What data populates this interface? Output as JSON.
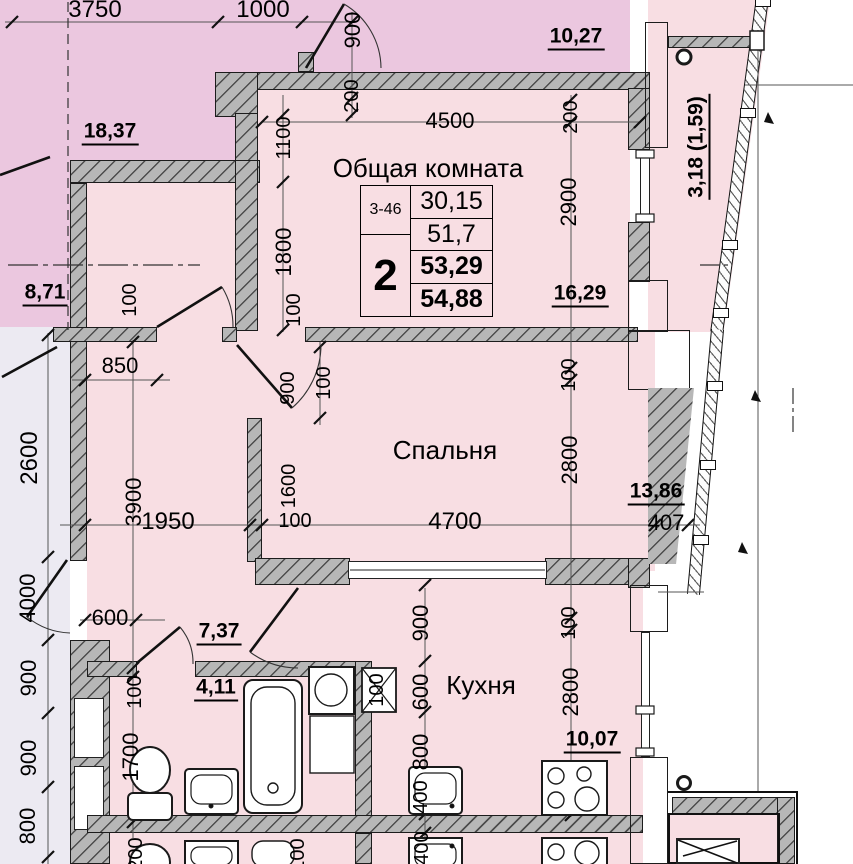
{
  "unit_table": {
    "unit_no": "3-46",
    "rooms_count": "2",
    "living_area": "30,15",
    "total_area": "51,7",
    "area_with_balcony_low": "53,29",
    "area_with_balcony_high": "54,88"
  },
  "rooms": [
    {
      "label": "Общая комната"
    },
    {
      "label": "Спальня"
    },
    {
      "label": "Кухня"
    }
  ],
  "area_values": [
    "18,37",
    "10,27",
    "8,71",
    "16,29",
    "13,86",
    "7,37",
    "4,11",
    "10,07",
    "3,18 (1,59)"
  ],
  "colors": {
    "apartment_fill": "#f8dee3",
    "neighbor_fill": "#ebc7df",
    "corridor_fill": "#eceaf2",
    "wall_gray": "#b7b7b7",
    "line_black": "#1a1a1a"
  },
  "labels": [
    {
      "t": "3750",
      "x": 95,
      "y": 10,
      "r": 0,
      "s": 24,
      "k": "dim"
    },
    {
      "t": "1000",
      "x": 263,
      "y": 10,
      "r": 0,
      "s": 24,
      "k": "dim"
    },
    {
      "t": "900",
      "x": 353,
      "y": 30,
      "r": -90,
      "s": 22,
      "k": "dim"
    },
    {
      "t": "200",
      "x": 352,
      "y": 96,
      "r": -90,
      "s": 20,
      "k": "dim"
    },
    {
      "t": "1100",
      "x": 284,
      "y": 138,
      "r": -90,
      "s": 20,
      "k": "dim"
    },
    {
      "t": "4500",
      "x": 450,
      "y": 121,
      "r": 0,
      "s": 22,
      "k": "dim"
    },
    {
      "t": "200",
      "x": 571,
      "y": 117,
      "r": -90,
      "s": 20,
      "k": "dim"
    },
    {
      "t": "2900",
      "x": 569,
      "y": 202,
      "r": -90,
      "s": 22,
      "k": "dim"
    },
    {
      "t": "1800",
      "x": 284,
      "y": 252,
      "r": -90,
      "s": 22,
      "k": "dim"
    },
    {
      "t": "100",
      "x": 130,
      "y": 300,
      "r": -90,
      "s": 20,
      "k": "dim"
    },
    {
      "t": "100",
      "x": 294,
      "y": 310,
      "r": -90,
      "s": 20,
      "k": "dim"
    },
    {
      "t": "900",
      "x": 288,
      "y": 388,
      "r": -90,
      "s": 20,
      "k": "dim"
    },
    {
      "t": "100",
      "x": 324,
      "y": 383,
      "r": -90,
      "s": 20,
      "k": "dim"
    },
    {
      "t": "100",
      "x": 569,
      "y": 375,
      "r": -90,
      "s": 20,
      "k": "dim"
    },
    {
      "t": "850",
      "x": 120,
      "y": 366,
      "r": 0,
      "s": 22,
      "k": "dim"
    },
    {
      "t": "2600",
      "x": 30,
      "y": 458,
      "r": -90,
      "s": 24,
      "k": "dim"
    },
    {
      "t": "1600",
      "x": 289,
      "y": 486,
      "r": -90,
      "s": 20,
      "k": "dim"
    },
    {
      "t": "2800",
      "x": 570,
      "y": 460,
      "r": -90,
      "s": 22,
      "k": "dim"
    },
    {
      "t": "3900",
      "x": 134,
      "y": 502,
      "r": -90,
      "s": 22,
      "k": "dim"
    },
    {
      "t": "1950",
      "x": 168,
      "y": 522,
      "r": 0,
      "s": 24,
      "k": "dim"
    },
    {
      "t": "100",
      "x": 295,
      "y": 521,
      "r": 0,
      "s": 20,
      "k": "dim"
    },
    {
      "t": "4700",
      "x": 455,
      "y": 522,
      "r": 0,
      "s": 24,
      "k": "dim"
    },
    {
      "t": "407",
      "x": 666,
      "y": 523,
      "r": 0,
      "s": 22,
      "k": "dim"
    },
    {
      "t": "4000",
      "x": 28,
      "y": 598,
      "r": -90,
      "s": 22,
      "k": "dim"
    },
    {
      "t": "600",
      "x": 110,
      "y": 618,
      "r": 0,
      "s": 22,
      "k": "dim"
    },
    {
      "t": "900",
      "x": 421,
      "y": 623,
      "r": -90,
      "s": 22,
      "k": "dim"
    },
    {
      "t": "100",
      "x": 135,
      "y": 692,
      "r": -90,
      "s": 20,
      "k": "dim"
    },
    {
      "t": "1700",
      "x": 131,
      "y": 757,
      "r": -90,
      "s": 22,
      "k": "dim"
    },
    {
      "t": "600",
      "x": 421,
      "y": 692,
      "r": -90,
      "s": 22,
      "k": "dim"
    },
    {
      "t": "100",
      "x": 377,
      "y": 690,
      "r": -90,
      "s": 20,
      "k": "dim"
    },
    {
      "t": "800",
      "x": 421,
      "y": 752,
      "r": -90,
      "s": 22,
      "k": "dim"
    },
    {
      "t": "400",
      "x": 421,
      "y": 797,
      "r": -90,
      "s": 20,
      "k": "dim"
    },
    {
      "t": "400",
      "x": 422,
      "y": 848,
      "r": -90,
      "s": 20,
      "k": "dim"
    },
    {
      "t": "900",
      "x": 29,
      "y": 678,
      "r": -90,
      "s": 22,
      "k": "dim"
    },
    {
      "t": "900",
      "x": 29,
      "y": 758,
      "r": -90,
      "s": 22,
      "k": "dim"
    },
    {
      "t": "800",
      "x": 28,
      "y": 826,
      "r": -90,
      "s": 22,
      "k": "dim"
    },
    {
      "t": "100",
      "x": 569,
      "y": 623,
      "r": -90,
      "s": 20,
      "k": "dim"
    },
    {
      "t": "2800",
      "x": 571,
      "y": 692,
      "r": -90,
      "s": 22,
      "k": "dim"
    },
    {
      "t": "200",
      "x": 136,
      "y": 854,
      "r": -90,
      "s": 20,
      "k": "dim"
    },
    {
      "t": "100",
      "x": 298,
      "y": 855,
      "r": -90,
      "s": 20,
      "k": "dim"
    },
    {
      "t": "18,37",
      "x": 110,
      "y": 133,
      "r": 0,
      "s": 21,
      "k": "area"
    },
    {
      "t": "10,27",
      "x": 576,
      "y": 38,
      "r": 0,
      "s": 21,
      "k": "area"
    },
    {
      "t": "8,71",
      "x": 45,
      "y": 294,
      "r": 0,
      "s": 21,
      "k": "area"
    },
    {
      "t": "16,29",
      "x": 580,
      "y": 295,
      "r": 0,
      "s": 21,
      "k": "area"
    },
    {
      "t": "13,86",
      "x": 656,
      "y": 493,
      "r": 0,
      "s": 21,
      "k": "area"
    },
    {
      "t": "7,37",
      "x": 219,
      "y": 633,
      "r": 0,
      "s": 21,
      "k": "area"
    },
    {
      "t": "4,11",
      "x": 216,
      "y": 689,
      "r": 0,
      "s": 21,
      "k": "area"
    },
    {
      "t": "10,07",
      "x": 592,
      "y": 741,
      "r": 0,
      "s": 21,
      "k": "area"
    },
    {
      "t": "3,18 (1,59)",
      "x": 698,
      "y": 147,
      "r": -90,
      "s": 21,
      "k": "area"
    },
    {
      "t": "Общая комната",
      "x": 428,
      "y": 168,
      "r": 0,
      "s": 26,
      "k": "room"
    },
    {
      "t": "Спальня",
      "x": 445,
      "y": 450,
      "r": 0,
      "s": 26,
      "k": "room"
    },
    {
      "t": "Кухня",
      "x": 481,
      "y": 685,
      "r": 0,
      "s": 26,
      "k": "room"
    }
  ]
}
